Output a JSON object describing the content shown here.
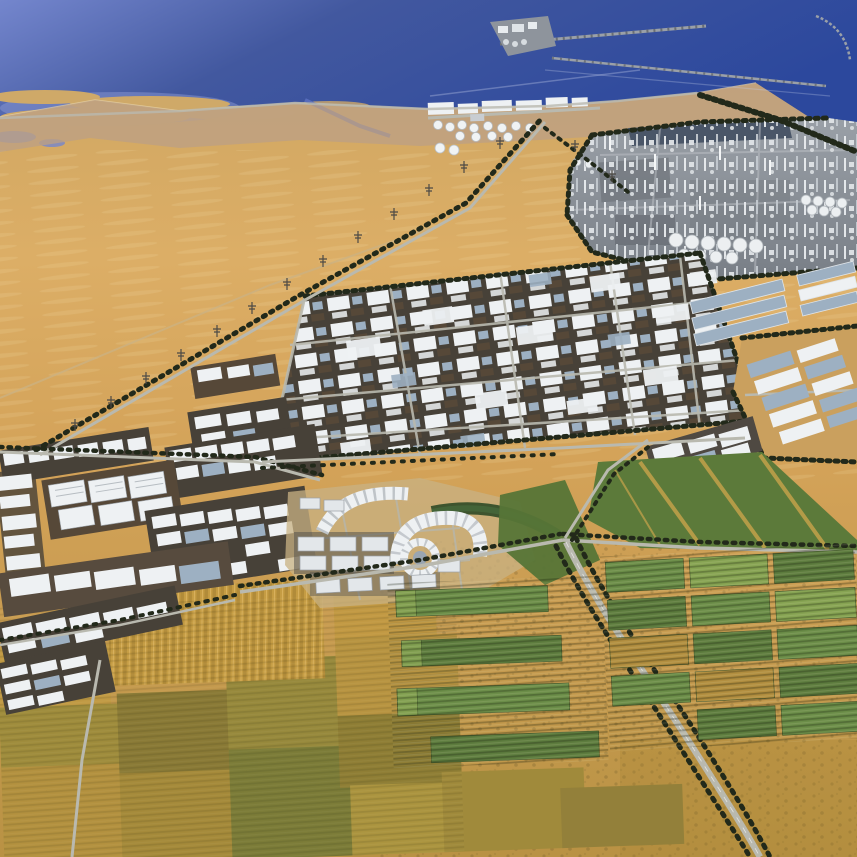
{
  "scene": {
    "kind": "aerial-masterplan-rendering",
    "regions": [
      {
        "name": "sea"
      },
      {
        "name": "breakwater-port"
      },
      {
        "name": "coastal-tank-farm"
      },
      {
        "name": "refinery-complex"
      },
      {
        "name": "logistics-park"
      },
      {
        "name": "western-industrial-clusters"
      },
      {
        "name": "eastern-business-park"
      },
      {
        "name": "town-centre"
      },
      {
        "name": "landscaped-interchange"
      },
      {
        "name": "highway"
      },
      {
        "name": "power-transmission-corridor"
      },
      {
        "name": "irrigated-farm-plots"
      },
      {
        "name": "dry-farmland"
      },
      {
        "name": "desert"
      }
    ]
  },
  "palette": {
    "sea_deep": "#2c489d",
    "sea_mid": "#42589f",
    "sea_light": "#7486cd",
    "shallow": "#8a97d2",
    "sandbar": "#cfa968",
    "canal": "#5a6fbe",
    "wake": "#c3cce8",
    "beach": "#e8d6ac",
    "sand": "#d2a55e",
    "sand_bright": "#dcae66",
    "sand_pale": "#e8cb92",
    "coast_sand": "#bda083",
    "road": "#b9b9af",
    "steel": "#9aa0a8",
    "tree": "#22291a",
    "plot_dark": "#474138",
    "plot_brown": "#564838",
    "roof_white": "#eef1f3",
    "roof_blue": "#9db0c2",
    "plant_gray": "#9aa0a7",
    "plant_mid": "#787e86",
    "plant_dark_band": "#4a5668",
    "tank": "#f0f3f4",
    "crop_green": "#5d7c3e",
    "crop_green_mid": "#6b8d48",
    "crop_green_light": "#86a352",
    "turf": "#5c7a3a",
    "turf_dark": "#39552b",
    "gold_field": "#c19a44",
    "olive_field": "#9f8c3c",
    "olive_dark": "#7c7c38",
    "brown_field": "#8a7a36",
    "streak_gold": "#c9a44b"
  }
}
